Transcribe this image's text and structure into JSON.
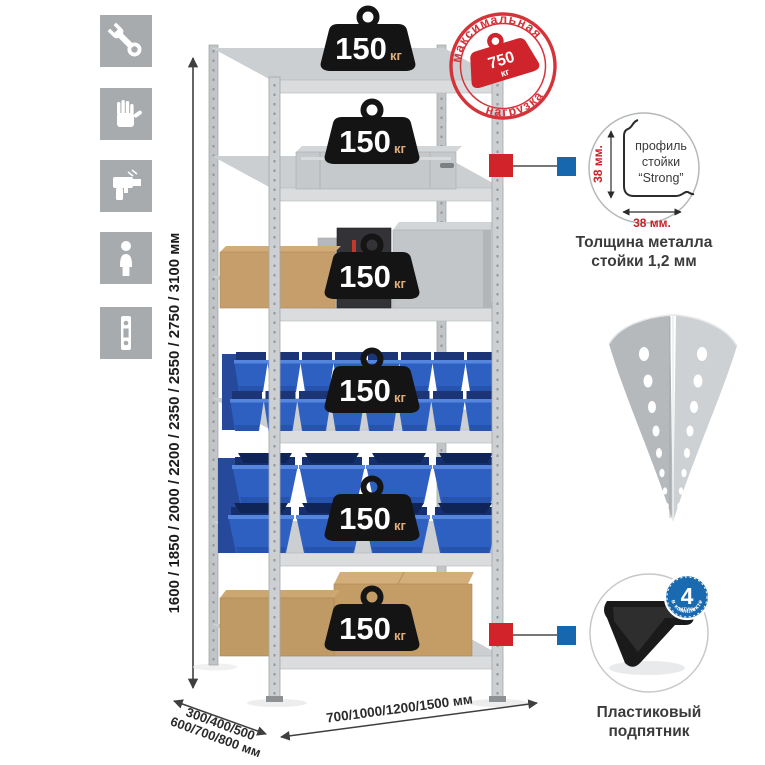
{
  "colors": {
    "accent_red": "#d2232b",
    "accent_blue": "#1667ae",
    "stamp_red": "#d5333a",
    "bin_blue": "#2e60c2",
    "metal_gray": "#c6c9cb",
    "cardboard": "#c49d66",
    "badge_black": "#141414"
  },
  "assembly_icons": {
    "items": [
      {
        "icon": "wrench-icon"
      },
      {
        "icon": "gloves-icon"
      },
      {
        "icon": "drill-icon"
      },
      {
        "icon": "person-icon"
      },
      {
        "icon": "perforated-strip-icon"
      }
    ]
  },
  "dimensions": {
    "height_label": "1600 / 1850 / 2000 / 2200 / 2350 / 2550 / 2750 / 3100 мм",
    "depth_label_line1": "300/400/500",
    "depth_label_line2": "600/700/800 мм",
    "width_label": "700/1000/1200/1500 мм"
  },
  "shelf_load_badge": {
    "value": "150",
    "unit": "кг"
  },
  "max_load_stamp": {
    "arc_top": "максимальная",
    "arc_bottom": "нагрузка",
    "value": "750",
    "unit": "кг"
  },
  "profile_detail": {
    "vertical_dim": "38 мм.",
    "horizontal_dim": "38 мм.",
    "label_line1": "профиль",
    "label_line2": "стойки",
    "label_line3": "“Strong”",
    "caption_line1": "Толщина металла",
    "caption_line2": "стойки 1,2 мм"
  },
  "foot_detail": {
    "badge_value": "4",
    "badge_unit": "штуки",
    "badge_arc": "в комплекте",
    "caption_line1": "Пластиковый",
    "caption_line2": "подпятник"
  }
}
